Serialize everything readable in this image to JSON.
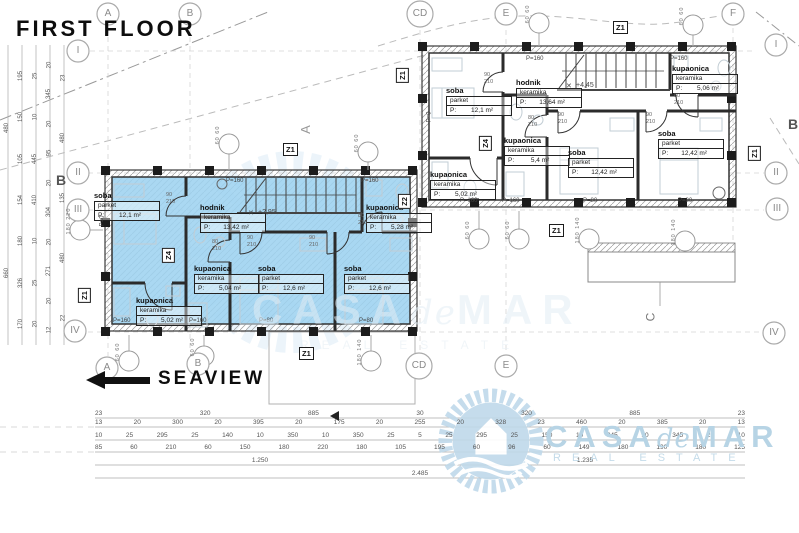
{
  "title": "FIRST FLOOR",
  "direction_label": "SEAVIEW",
  "watermark": {
    "casa": "CASA",
    "de": "de",
    "mar": "MAR",
    "tagline": "REAL ESTATE"
  },
  "grid": {
    "top": [
      "A",
      "B",
      "CD",
      "E",
      "F"
    ],
    "bottom": [
      "A",
      "B",
      "CD",
      "E"
    ],
    "left": [
      "I",
      "II",
      "III",
      "IV"
    ],
    "right": [
      "I",
      "II",
      "III",
      "IV"
    ],
    "axis_b": "B"
  },
  "z_labels": {
    "z1": "Z1",
    "z2": "Z2",
    "z4": "Z4"
  },
  "section_labels": {
    "a": "A",
    "c": "C"
  },
  "levels": {
    "blue_level": "+2,95",
    "white_level": "+4,45"
  },
  "apartments": {
    "blue": {
      "rooms": [
        {
          "name": "soba",
          "material": "parket",
          "area_label": "P:",
          "area": "12,1 m²"
        },
        {
          "name": "hodnik",
          "material": "keramika",
          "area_label": "P:",
          "area": "13,42 m²"
        },
        {
          "name": "kupaonica",
          "material": "keramika",
          "area_label": "P:",
          "area": "5,28 m²"
        },
        {
          "name": "kupaonica",
          "material": "keramika",
          "area_label": "P:",
          "area": "5,04 m²"
        },
        {
          "name": "soba",
          "material": "parket",
          "area_label": "P:",
          "area": "12,6 m²"
        },
        {
          "name": "soba",
          "material": "parket",
          "area_label": "P:",
          "area": "12,6 m²"
        },
        {
          "name": "kupaonica",
          "material": "keramika",
          "area_label": "P:",
          "area": "5,02 m²"
        }
      ]
    },
    "white": {
      "rooms": [
        {
          "name": "soba",
          "material": "parket",
          "area_label": "P:",
          "area": "12,1 m²"
        },
        {
          "name": "hodnik",
          "material": "keramika",
          "area_label": "P:",
          "area": "13,64 m²"
        },
        {
          "name": "kupaonica",
          "material": "keramika",
          "area_label": "P:",
          "area": "5,4 m²"
        },
        {
          "name": "kupaonica",
          "material": "keramika",
          "area_label": "P:",
          "area": "5,02 m²"
        },
        {
          "name": "kupaonica",
          "material": "keramika",
          "area_label": "P:",
          "area": "5,06 m²"
        },
        {
          "name": "soba",
          "material": "parket",
          "area_label": "P:",
          "area": "12,42 m²"
        },
        {
          "name": "soba",
          "material": "parket",
          "area_label": "P:",
          "area": "12,42 m²"
        }
      ]
    }
  },
  "parapet_labels": {
    "p160": "P=160",
    "p80": "P=80",
    "p0": "P=0"
  },
  "door_dims": {
    "w90": "90",
    "w80": "80",
    "h210": "210"
  },
  "measure_labels": {
    "p6060": "60  60",
    "p180140": "180  140",
    "p180220": "180  220"
  },
  "dims": {
    "bottom": {
      "row1": [
        "23",
        "320",
        "885",
        "30",
        "320",
        "885",
        "23"
      ],
      "row2": [
        "13",
        "20",
        "300",
        "20",
        "395",
        "20",
        "175",
        "20",
        "255",
        "20",
        "328",
        "23",
        "460",
        "20",
        "385",
        "20",
        "13"
      ],
      "row3": [
        "10",
        "25",
        "295",
        "25",
        "140",
        "10",
        "350",
        "10",
        "350",
        "25",
        "5",
        "25",
        "295",
        "25",
        "150",
        "10",
        "345",
        "10",
        "345",
        "25",
        "10"
      ],
      "row4": [
        "85",
        "60",
        "210",
        "60",
        "150",
        "180",
        "220",
        "180",
        "105",
        "195",
        "60",
        "96",
        "60",
        "149",
        "180",
        "190",
        "180",
        "125"
      ],
      "total_left": "1.250",
      "total_right": "1.235",
      "total": "2.485"
    },
    "left": {
      "c1": [
        "480",
        "660"
      ],
      "c2": [
        "195",
        "150",
        "105",
        "154",
        "180",
        "326",
        "170"
      ],
      "c3": [
        "25",
        "10",
        "445",
        "410",
        "10",
        "25",
        "20"
      ],
      "c4": [
        "20",
        "345",
        "20",
        "95",
        "20",
        "304",
        "20",
        "271",
        "20",
        "12"
      ],
      "c5": [
        "23",
        "480",
        "135",
        "480",
        "22"
      ]
    }
  },
  "colors": {
    "apartment_fill": "#9fd3ef",
    "watermark": "#bfd9ea",
    "wall": "#2b2b2b"
  }
}
